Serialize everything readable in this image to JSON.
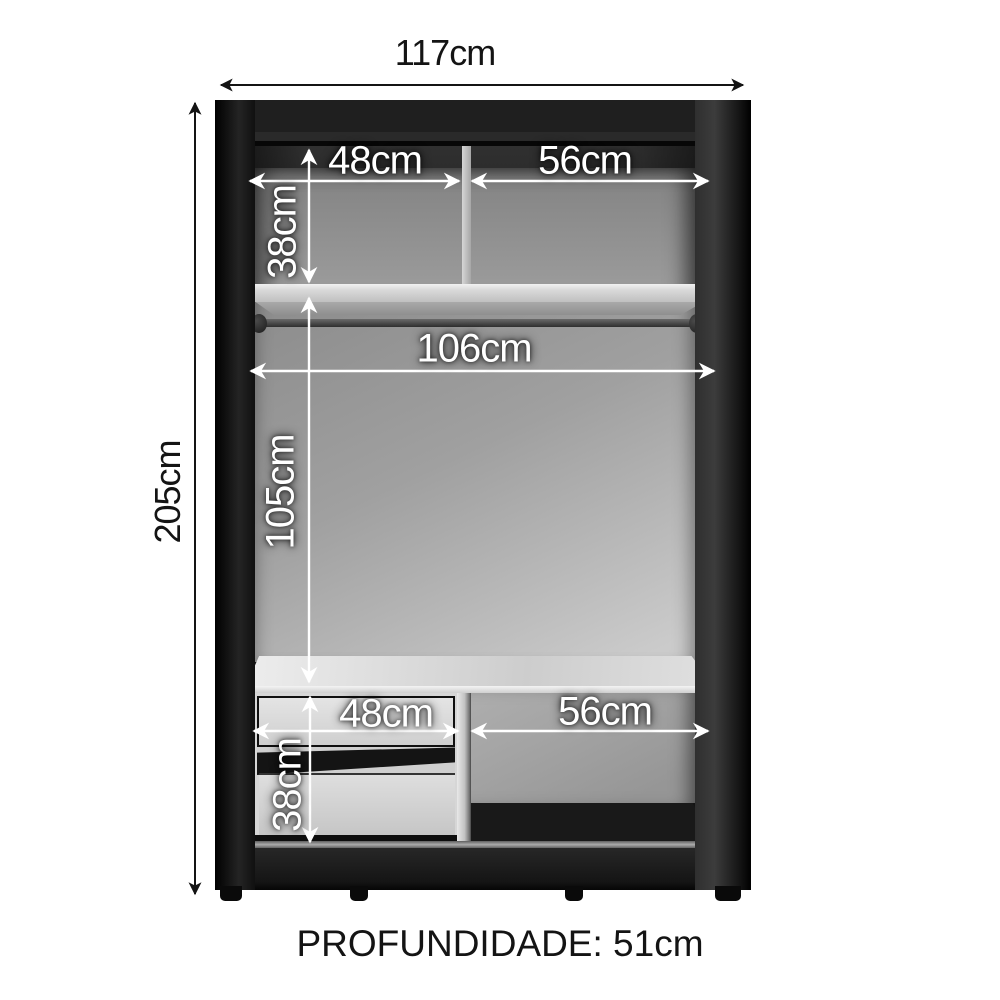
{
  "diagram": {
    "type": "wardrobe-internal-dimensions",
    "dimensions": {
      "overall_width": "117cm",
      "overall_height": "205cm",
      "top_left_width": "48cm",
      "top_right_width": "56cm",
      "top_section_height": "38cm",
      "rod_clearance_width": "106cm",
      "hanging_height": "105cm",
      "bottom_left_width": "48cm",
      "bottom_right_width": "56cm",
      "bottom_section_height": "38cm",
      "depth_label": "PROFUNDIDADE: 51cm"
    },
    "colors": {
      "frame_black": "#1c1c1c",
      "back_panel_gray": "#a0a0a0",
      "shelf_light": "#d8d8d8",
      "annotation_white": "#ffffff",
      "annotation_black": "#141414",
      "background": "#ffffff"
    }
  }
}
